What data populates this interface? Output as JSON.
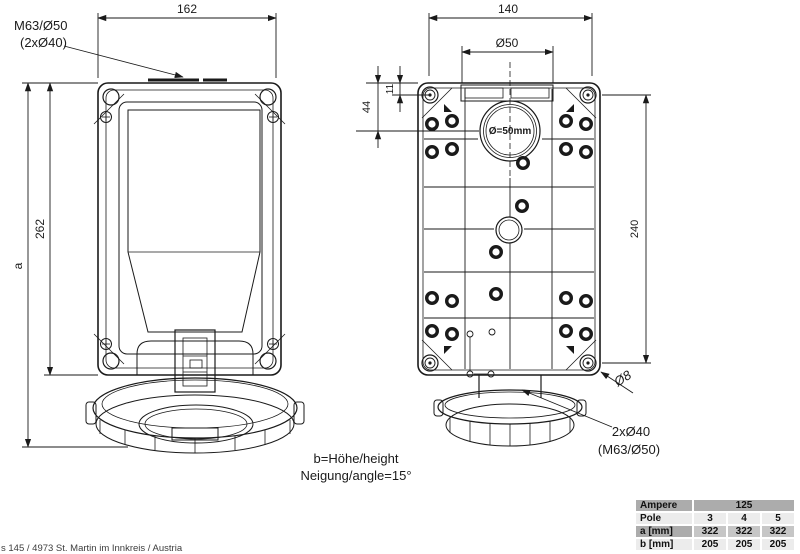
{
  "drawing": {
    "front_view": {
      "callout_line1": "M63/Ø50",
      "callout_line2": "(2xØ40)",
      "dim_width": "162",
      "dim_height": "262",
      "dim_overall": "a"
    },
    "back_view": {
      "dim_width": "140",
      "dim_entry": "Ø50",
      "dim_offset_small": "11",
      "dim_offset_large": "44",
      "dim_height": "240",
      "dim_mount_hole": "Ø8",
      "knockout_label": "Ø=50mm",
      "callout_line1": "2xØ40",
      "callout_line2": "(M63/Ø50)"
    },
    "notes": {
      "line1": "b=Höhe/height",
      "line2": "Neigung/angle=15°"
    },
    "footer": "s 145 / 4973 St. Martin im Innkreis / Austria"
  },
  "spec_table": {
    "header_label": "Ampere",
    "header_value": "125",
    "rows": [
      {
        "label": "Pole",
        "values": [
          "3",
          "4",
          "5"
        ]
      },
      {
        "label": "a [mm]",
        "values": [
          "322",
          "322",
          "322"
        ]
      },
      {
        "label": "b [mm]",
        "values": [
          "205",
          "205",
          "205"
        ]
      }
    ]
  }
}
